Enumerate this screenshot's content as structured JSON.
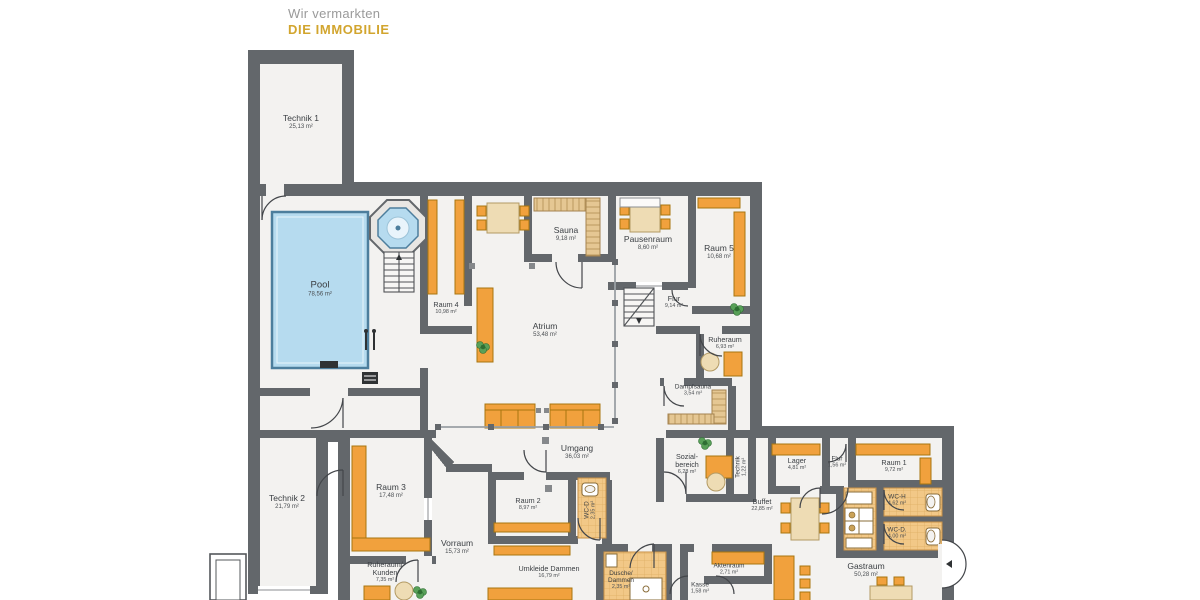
{
  "logo": {
    "line1": "Wir vermarkten",
    "line2": "DIE IMMOBILIE",
    "accent_color": "#d2a52e",
    "gray_color": "#9a9a9a"
  },
  "palette": {
    "wall": "#63676b",
    "room": "#f3f2f0",
    "pool_water": "#b6dbef",
    "pool_edge": "#4d7e9d",
    "furniture_orange": "#f1a13d",
    "furniture_edge": "#a8750f",
    "tile": "#f2c887",
    "wood": "#e5c793",
    "plant_green": "#58a058",
    "label_text": "#3a3e42"
  },
  "rooms": [
    {
      "name": "Technik 1",
      "area": "25,13 m²"
    },
    {
      "name": "Pool",
      "area": "78,56 m²"
    },
    {
      "name": "Raum 4",
      "area": "10,98 m²"
    },
    {
      "name": "Atrium",
      "area": "53,48 m²"
    },
    {
      "name": "Sauna",
      "area": "9,18 m²"
    },
    {
      "name": "Pausenraum",
      "area": "8,60 m²"
    },
    {
      "name": "Raum 5",
      "area": "10,68 m²"
    },
    {
      "name": "Flur",
      "area": "9,14 m²"
    },
    {
      "name": "Ruheraum",
      "area": "6,93 m²"
    },
    {
      "name": "Dampfsauna",
      "area": "3,54 m²"
    },
    {
      "name": "Umgang",
      "area": "36,03 m²"
    },
    {
      "name": "Sozial-\nbereich",
      "area": "6,28 m²"
    },
    {
      "name": "Technik",
      "area": "1,22 m²"
    },
    {
      "name": "Technik 2",
      "area": "21,79 m²"
    },
    {
      "name": "Raum 3",
      "area": "17,48 m²"
    },
    {
      "name": "Ruheraum/\nKunden",
      "area": "7,35 m²"
    },
    {
      "name": "Vorraum",
      "area": "15,73 m²"
    },
    {
      "name": "Raum 2",
      "area": "8,97 m²"
    },
    {
      "name": "WC-D",
      "area": "2,35 m²"
    },
    {
      "name": "Umkleide Dammen",
      "area": "16,79 m²"
    },
    {
      "name": "Dusche/\nDammen",
      "area": "2,35 m²"
    },
    {
      "name": "Kasse",
      "area": "1,58 m²"
    },
    {
      "name": "Aktenraum",
      "area": "2,71 m²"
    },
    {
      "name": "Buffet",
      "area": "22,85 m²"
    },
    {
      "name": "Lager",
      "area": "4,81 m²"
    },
    {
      "name": "Flur",
      "area": "1,56 m²"
    },
    {
      "name": "Raum 1",
      "area": "9,72 m²"
    },
    {
      "name": "WC-H",
      "area": "4,62 m²"
    },
    {
      "name": "WC-D.",
      "area": "4,00 m²"
    },
    {
      "name": "Gastraum",
      "area": "50,28 m²"
    }
  ]
}
